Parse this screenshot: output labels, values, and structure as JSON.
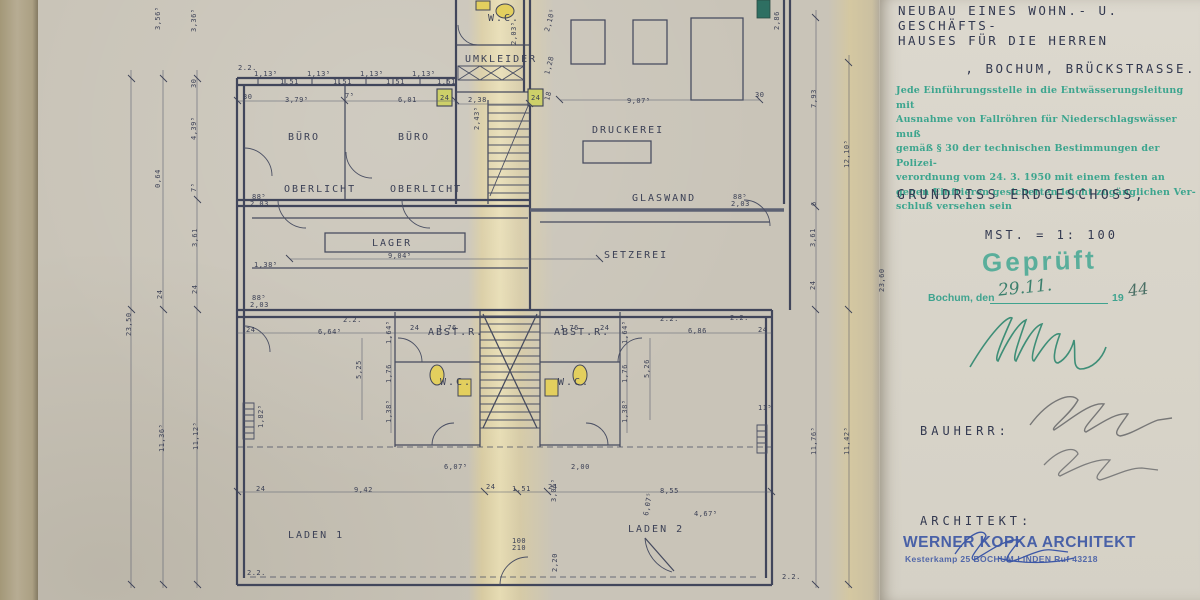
{
  "panel": {
    "title_lines": [
      "NEUBAU EINES WOHN.- U. GESCHÄFTS-",
      "HAUSES FÜR DIE HERREN",
      ", BOCHUM, BRÜCKSTRASSE."
    ],
    "regulation_stamp_lines": [
      "Jede Einführungsstelle in die Entwässerungsleitung mit",
      "Ausnahme von Fallröhren für Niederschlagswässer muß",
      "gemäß § 30 der technischen Bestimmungen der Polizei-",
      "verordnung vom 24. 3. 1950 mit einem festen an",
      "gegen Einfrieren gesicherten leicht zugänglichen Ver-",
      "schluß versehen sein"
    ],
    "drawing_title": "GRUNDRISS ERDGESCHOSS,",
    "scale_label": "MST. =  1: 100",
    "approval": {
      "stamp_word": "Geprüft",
      "city_label": "Bochum, den",
      "date_hand": "29.11.",
      "year_print": "19",
      "year_hand": "44"
    },
    "bauherr_label": "BAUHERR:",
    "architekt_label": "ARCHITEKT:",
    "architect_stamp_line1": "WERNER KOPKA ARCHITEKT",
    "architect_stamp_line2": "Kesterkamp 25    BOCHUM-LINDEN    Ruf 43218"
  },
  "plan": {
    "room_labels": [
      {
        "t": "BÜRO",
        "x": 288,
        "y": 140
      },
      {
        "t": "BÜRO",
        "x": 398,
        "y": 140
      },
      {
        "t": "W.C.",
        "x": 488,
        "y": 21,
        "s": 8
      },
      {
        "t": "UMKLEIDER",
        "x": 465,
        "y": 62,
        "s": 7.5
      },
      {
        "t": "DRUCKEREI",
        "x": 592,
        "y": 133
      },
      {
        "t": "GLASWAND",
        "x": 632,
        "y": 201,
        "s": 8
      },
      {
        "t": "OBERLICHT",
        "x": 284,
        "y": 192,
        "s": 7.5
      },
      {
        "t": "OBERLICHT",
        "x": 390,
        "y": 192,
        "s": 7.5
      },
      {
        "t": "LAGER",
        "x": 372,
        "y": 246,
        "s": 9
      },
      {
        "t": "SETZEREI",
        "x": 604,
        "y": 258
      },
      {
        "t": "ABST.R.",
        "x": 428,
        "y": 335,
        "s": 7
      },
      {
        "t": "ABST.R.",
        "x": 554,
        "y": 335,
        "s": 7
      },
      {
        "t": "W.C.",
        "x": 440,
        "y": 385,
        "s": 8
      },
      {
        "t": "W.C.",
        "x": 558,
        "y": 385,
        "s": 8
      },
      {
        "t": "LADEN  1",
        "x": 288,
        "y": 538,
        "s": 11,
        "w": 4
      },
      {
        "t": "LADEN  2",
        "x": 628,
        "y": 532,
        "s": 11,
        "w": 4
      }
    ],
    "dim_labels": [
      {
        "t": "2.2.",
        "x": 238,
        "y": 70,
        "s": 8
      },
      {
        "t": "1,13⁵",
        "x": 254,
        "y": 76,
        "s": 6
      },
      {
        "t": "1,51",
        "x": 280,
        "y": 84,
        "s": 6
      },
      {
        "t": "1,13⁵",
        "x": 307,
        "y": 76,
        "s": 6
      },
      {
        "t": "1,51",
        "x": 333,
        "y": 84,
        "s": 6
      },
      {
        "t": "1,13⁵",
        "x": 360,
        "y": 76,
        "s": 6
      },
      {
        "t": "1,51",
        "x": 386,
        "y": 84,
        "s": 6
      },
      {
        "t": "1,13⁵",
        "x": 412,
        "y": 76,
        "s": 6
      },
      {
        "t": "1,51",
        "x": 437,
        "y": 84,
        "s": 6
      },
      {
        "t": "30",
        "x": 243,
        "y": 99,
        "s": 6
      },
      {
        "t": "3,79⁵",
        "x": 285,
        "y": 102
      },
      {
        "t": "7⁵",
        "x": 345,
        "y": 98,
        "s": 6
      },
      {
        "t": "6,01",
        "x": 398,
        "y": 102
      },
      {
        "t": "24",
        "x": 440,
        "y": 100,
        "s": 6
      },
      {
        "t": "2,38",
        "x": 468,
        "y": 102
      },
      {
        "t": "24",
        "x": 531,
        "y": 100,
        "s": 6
      },
      {
        "t": "9,07⁵",
        "x": 627,
        "y": 103
      },
      {
        "t": "30",
        "x": 755,
        "y": 97,
        "s": 6
      },
      {
        "t": "2,03⁵",
        "x": 516,
        "y": 45,
        "r": -90,
        "s": 5.5
      },
      {
        "t": "2,43⁵",
        "x": 479,
        "y": 130,
        "r": -90,
        "s": 5.5
      },
      {
        "t": "2,10⁵",
        "x": 549,
        "y": 32,
        "r": -75,
        "s": 5.5
      },
      {
        "t": "1,28",
        "x": 549,
        "y": 75,
        "r": -75,
        "s": 5.5
      },
      {
        "t": "18",
        "x": 549,
        "y": 101,
        "r": -75,
        "s": 5.5
      },
      {
        "t": "2,86",
        "x": 779,
        "y": 30,
        "r": -90
      },
      {
        "t": "3,56⁵",
        "x": 160,
        "y": 30,
        "r": -90
      },
      {
        "t": "3,36⁵",
        "x": 196,
        "y": 32,
        "r": -90
      },
      {
        "t": "30",
        "x": 196,
        "y": 88,
        "r": -90,
        "s": 6
      },
      {
        "t": "4,39⁵",
        "x": 196,
        "y": 140,
        "r": -90
      },
      {
        "t": "0,64",
        "x": 160,
        "y": 188,
        "r": -90
      },
      {
        "t": "7⁵",
        "x": 196,
        "y": 192,
        "r": -90,
        "s": 6
      },
      {
        "t": "3,61",
        "x": 197,
        "y": 247,
        "r": -90
      },
      {
        "t": "24",
        "x": 197,
        "y": 294,
        "r": -90,
        "s": 6
      },
      {
        "t": "24",
        "x": 162,
        "y": 299,
        "r": -90,
        "s": 6
      },
      {
        "t": "23,50",
        "x": 131,
        "y": 336,
        "r": -90,
        "s": 8
      },
      {
        "t": "11,36⁵",
        "x": 164,
        "y": 452,
        "r": -90
      },
      {
        "t": "11,12⁵",
        "x": 198,
        "y": 450,
        "r": -90
      },
      {
        "t": "7,93",
        "x": 816,
        "y": 108,
        "r": -90
      },
      {
        "t": "12,10⁵",
        "x": 849,
        "y": 168,
        "r": -90
      },
      {
        "t": "6",
        "x": 816,
        "y": 206,
        "r": -90,
        "s": 6
      },
      {
        "t": "3,61",
        "x": 815,
        "y": 247,
        "r": -90
      },
      {
        "t": "24",
        "x": 815,
        "y": 290,
        "r": -90,
        "s": 6
      },
      {
        "t": "23,60",
        "x": 884,
        "y": 292,
        "r": -90,
        "s": 8
      },
      {
        "t": "11,76⁵",
        "x": 816,
        "y": 455,
        "r": -90
      },
      {
        "t": "11,42⁵",
        "x": 849,
        "y": 455,
        "r": -90
      },
      {
        "t": "88⁵",
        "x": 252,
        "y": 199,
        "s": 5.5
      },
      {
        "t": "2,03",
        "x": 250,
        "y": 206,
        "s": 5.5
      },
      {
        "t": "88⁵",
        "x": 733,
        "y": 199,
        "s": 5.5
      },
      {
        "t": "2,03",
        "x": 731,
        "y": 206,
        "s": 5.5
      },
      {
        "t": "88⁵",
        "x": 252,
        "y": 300,
        "s": 5.5
      },
      {
        "t": "2,03",
        "x": 250,
        "y": 307,
        "s": 5.5
      },
      {
        "t": "1,38⁵",
        "x": 254,
        "y": 267,
        "s": 6
      },
      {
        "t": "9,04⁵",
        "x": 388,
        "y": 258
      },
      {
        "t": "2.2.",
        "x": 343,
        "y": 322,
        "s": 8
      },
      {
        "t": "2.2.",
        "x": 660,
        "y": 321,
        "s": 8
      },
      {
        "t": "2.2.",
        "x": 730,
        "y": 320,
        "s": 8
      },
      {
        "t": "6,64⁵",
        "x": 318,
        "y": 334
      },
      {
        "t": "1,76",
        "x": 438,
        "y": 330
      },
      {
        "t": "1,76",
        "x": 560,
        "y": 330
      },
      {
        "t": "6,86",
        "x": 688,
        "y": 333
      },
      {
        "t": "24",
        "x": 246,
        "y": 332,
        "s": 6
      },
      {
        "t": "24",
        "x": 410,
        "y": 330,
        "s": 6
      },
      {
        "t": "24",
        "x": 600,
        "y": 330,
        "s": 6
      },
      {
        "t": "24",
        "x": 758,
        "y": 332,
        "s": 6
      },
      {
        "t": "5,25",
        "x": 361,
        "y": 379,
        "r": -90
      },
      {
        "t": "5,26",
        "x": 649,
        "y": 378,
        "r": -90
      },
      {
        "t": "1,64⁵",
        "x": 391,
        "y": 344,
        "r": -90,
        "s": 6
      },
      {
        "t": "1,76",
        "x": 391,
        "y": 383,
        "r": -90,
        "s": 6
      },
      {
        "t": "1,38⁵",
        "x": 391,
        "y": 423,
        "r": -90,
        "s": 6
      },
      {
        "t": "1,64⁵",
        "x": 627,
        "y": 344,
        "r": -90,
        "s": 6
      },
      {
        "t": "1,76",
        "x": 627,
        "y": 383,
        "r": -90,
        "s": 6
      },
      {
        "t": "1,38⁵",
        "x": 627,
        "y": 423,
        "r": -90,
        "s": 6
      },
      {
        "t": "1,82⁵",
        "x": 263,
        "y": 428,
        "r": -90,
        "s": 6
      },
      {
        "t": "11⁵",
        "x": 758,
        "y": 410,
        "s": 5.5
      },
      {
        "t": "6,07⁵",
        "x": 444,
        "y": 469
      },
      {
        "t": "2,00",
        "x": 571,
        "y": 469
      },
      {
        "t": "4,67⁵",
        "x": 694,
        "y": 516,
        "s": 6
      },
      {
        "t": "3,05⁵",
        "x": 556,
        "y": 502,
        "r": -90,
        "s": 5.5
      },
      {
        "t": "6,07⁵",
        "x": 648,
        "y": 516,
        "r": -80,
        "s": 6.5
      },
      {
        "t": "9,42",
        "x": 354,
        "y": 492,
        "s": 8
      },
      {
        "t": "24",
        "x": 256,
        "y": 491,
        "s": 6
      },
      {
        "t": "24",
        "x": 486,
        "y": 489,
        "s": 6
      },
      {
        "t": "1,51",
        "x": 512,
        "y": 491
      },
      {
        "t": "24",
        "x": 548,
        "y": 489,
        "s": 6
      },
      {
        "t": "8,55",
        "x": 660,
        "y": 493,
        "s": 8
      },
      {
        "t": "100",
        "x": 512,
        "y": 543,
        "s": 5.5
      },
      {
        "t": "210",
        "x": 512,
        "y": 550,
        "s": 5.5
      },
      {
        "t": "2,20",
        "x": 557,
        "y": 572,
        "r": -90,
        "s": 6
      },
      {
        "t": "2.2.",
        "x": 247,
        "y": 575,
        "s": 9
      },
      {
        "t": "2.2.",
        "x": 782,
        "y": 579,
        "s": 9
      }
    ]
  },
  "colors": {
    "ink": "#3c4156",
    "stamp_green": "#2fa189",
    "stamp_teal": "#45a893",
    "stamp_blue": "#3a55a4",
    "pencil": "#777777",
    "highlight_yellow": "#e3cf5e",
    "fold_yellow": "#e7dcb0"
  }
}
